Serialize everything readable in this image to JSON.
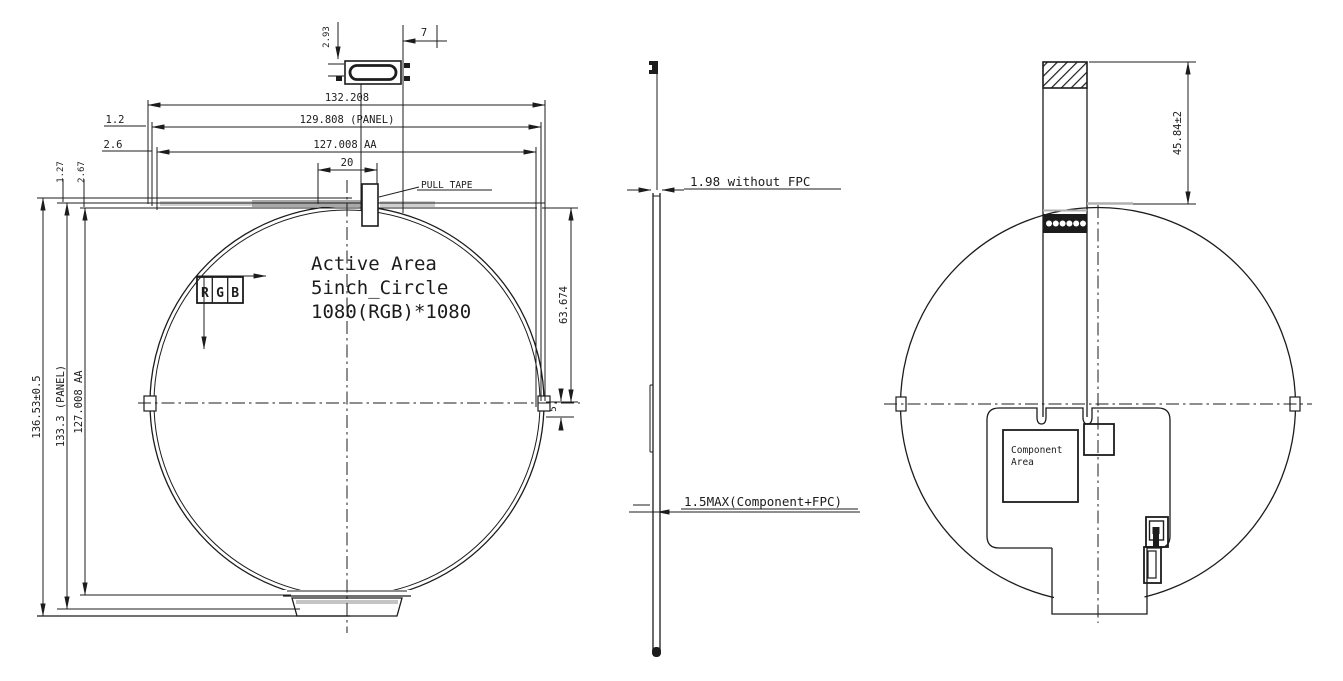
{
  "colors": {
    "line": "#1c1c1c",
    "gray": "#b0b0b0",
    "background": "#ffffff"
  },
  "front_view": {
    "dims": {
      "connector_height": "2.93",
      "connector_offset": "7",
      "overall_width": "132.208",
      "panel_width": "129.808 (PANEL)",
      "panel_width_offset": "1.2",
      "aa_width": "127.008 AA",
      "aa_width_offset": "2.6",
      "tape_width": "20",
      "top_offset_a": "1.27",
      "top_offset_b": "2.67",
      "overall_height": "136.53±0.5",
      "panel_height": "133.3 (PANEL)",
      "aa_height": "127.008 AA",
      "top_to_center": "63.674",
      "center_offset": "5"
    },
    "labels": {
      "pull_tape": "PULL TAPE",
      "rgb": "RGB",
      "active_area_1": "Active Area",
      "active_area_2": "5inch_Circle",
      "active_area_3": "1080(RGB)*1080"
    }
  },
  "side_view": {
    "labels": {
      "thickness_without_fpc": "1.98 without FPC",
      "thickness_max": "1.5MAX(Component+FPC)"
    }
  },
  "back_view": {
    "dims": {
      "fpc_length": "45.84±2"
    },
    "labels": {
      "component_area_1": "Component",
      "component_area_2": "Area"
    }
  }
}
